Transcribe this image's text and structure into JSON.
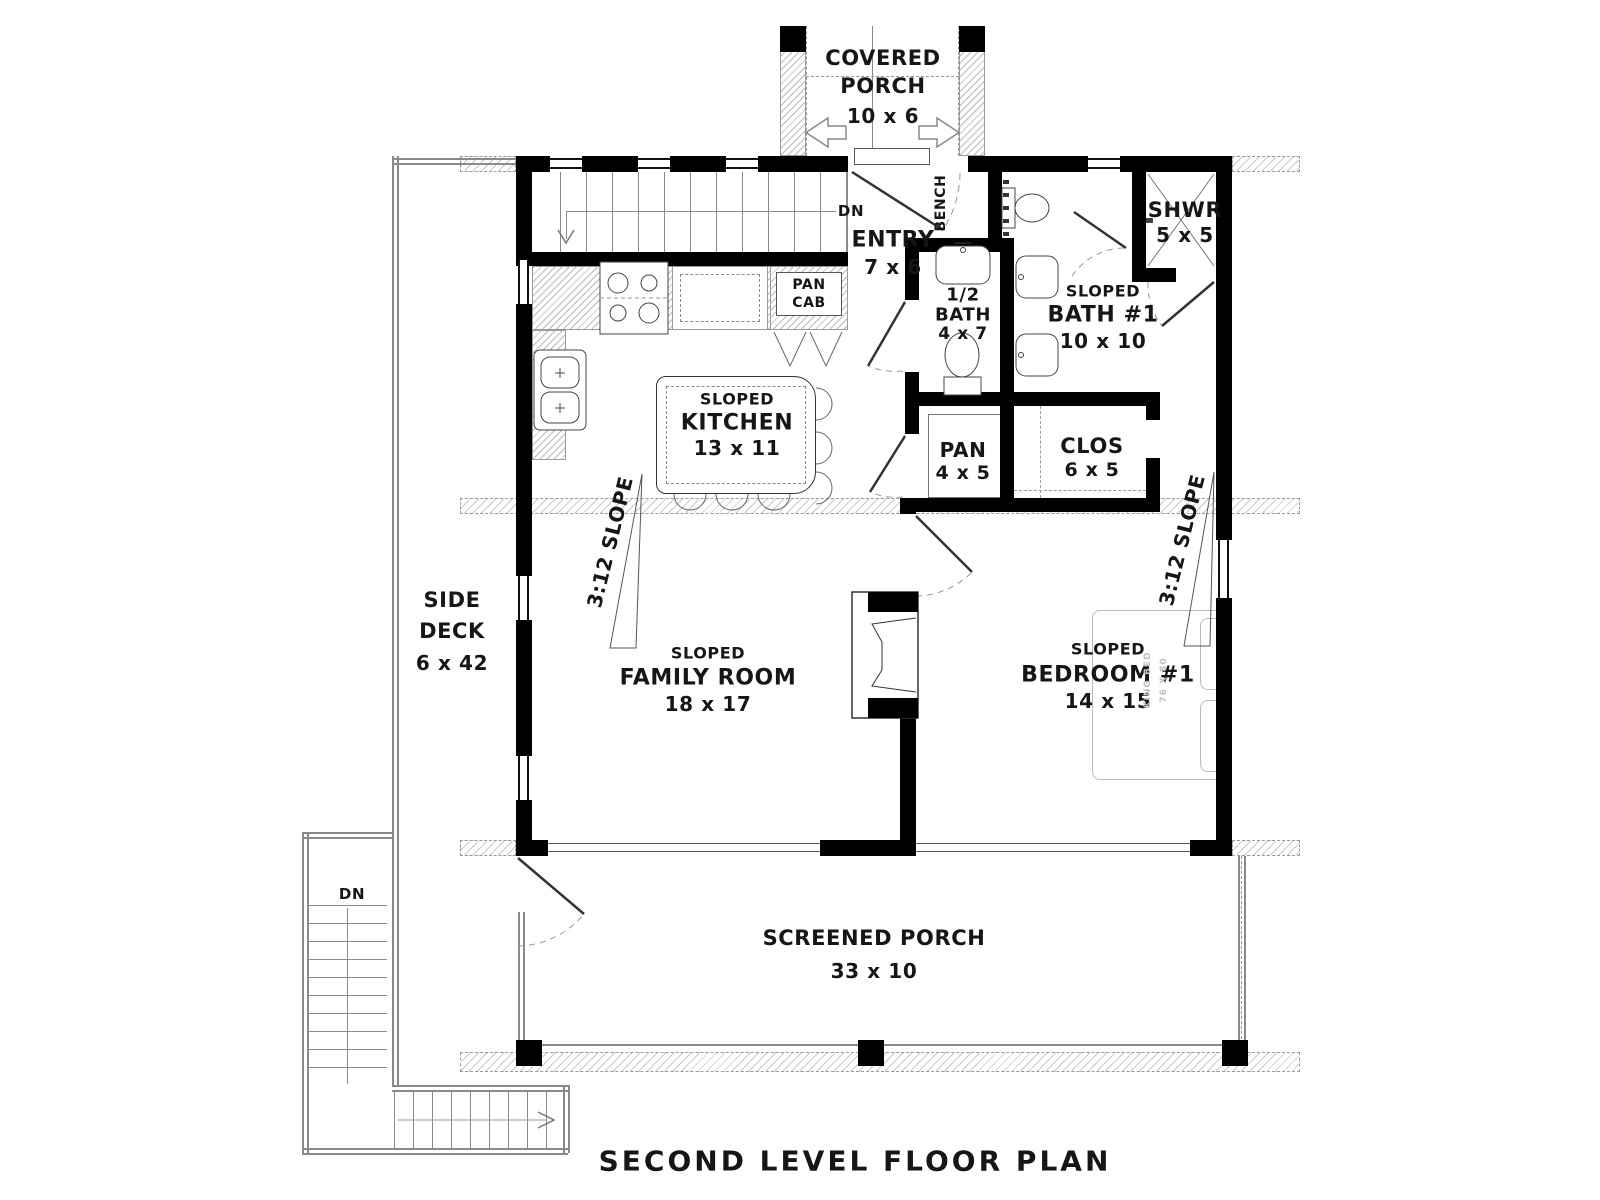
{
  "title": "SECOND LEVEL FLOOR PLAN",
  "rooms": {
    "covered_porch": {
      "line1": "COVERED",
      "line2": "PORCH",
      "size": "10 x 6"
    },
    "entry": {
      "name": "ENTRY",
      "size": "7 x 6"
    },
    "shower": {
      "name": "SHWR",
      "size": "5 x 5"
    },
    "half_bath": {
      "line1": "1/2",
      "line2": "BATH",
      "size": "4 x 7"
    },
    "bath1": {
      "modifier": "SLOPED",
      "name": "BATH #1",
      "size": "10 x 10"
    },
    "kitchen": {
      "modifier": "SLOPED",
      "name": "KITCHEN",
      "size": "13 x 11"
    },
    "pantry": {
      "name": "PAN",
      "size": "4 x 5"
    },
    "closet": {
      "name": "CLOS",
      "size": "6 x 5"
    },
    "side_deck": {
      "line1": "SIDE",
      "line2": "DECK",
      "size": "6 x 42"
    },
    "family_room": {
      "modifier": "SLOPED",
      "name": "FAMILY ROOM",
      "size": "18 x 17"
    },
    "bedroom1": {
      "modifier": "SLOPED",
      "name": "BEDROOM #1",
      "size": "14 x 15"
    },
    "screened_porch": {
      "name": "SCREENED PORCH",
      "size": "33 x 10"
    }
  },
  "annotations": {
    "pan_cab_line1": "PAN",
    "pan_cab_line2": "CAB",
    "bench": "BENCH",
    "dn_upper": "DN",
    "dn_lower": "DN",
    "slope_left": "3:12 SLOPE",
    "slope_right": "3:12 SLOPE",
    "bed_line1": "KING BED",
    "bed_line2": "76 X 80"
  },
  "colors": {
    "wall": "#000000",
    "line": "#8a8a8a",
    "hatch": "#b9b9b9",
    "text": "#161616",
    "faint": "#c0c0c0"
  }
}
